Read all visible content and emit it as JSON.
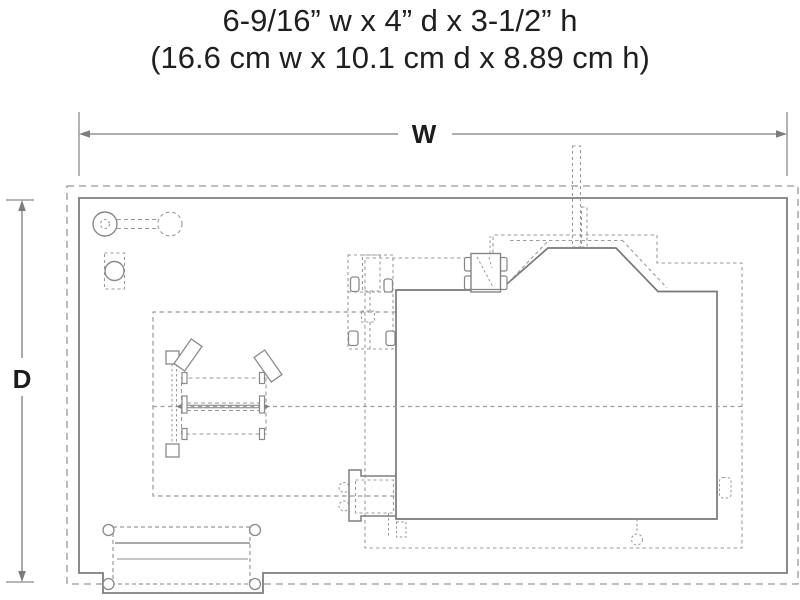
{
  "title": {
    "line1": "6-9/16” w x 4” d x 3-1/2” h",
    "line2": "(16.6 cm w x 10.1 cm d x 8.89 cm h)"
  },
  "dimensions": {
    "width_label": "W",
    "depth_label": "D"
  },
  "diagram": {
    "type": "footprint-plan",
    "parts": [
      "base-plate",
      "building-footprint",
      "roof-overhang",
      "chimney",
      "rooftop-cart",
      "truck",
      "assembly-jig",
      "wheel-detail",
      "roller-detail",
      "loading-dock",
      "platform-steps"
    ]
  },
  "colors": {
    "background": "#ffffff",
    "text": "#211e1f",
    "solid_line": "#7d7d7d",
    "dashed_line": "#9a9a9a",
    "light_line": "#bdbdbd"
  }
}
